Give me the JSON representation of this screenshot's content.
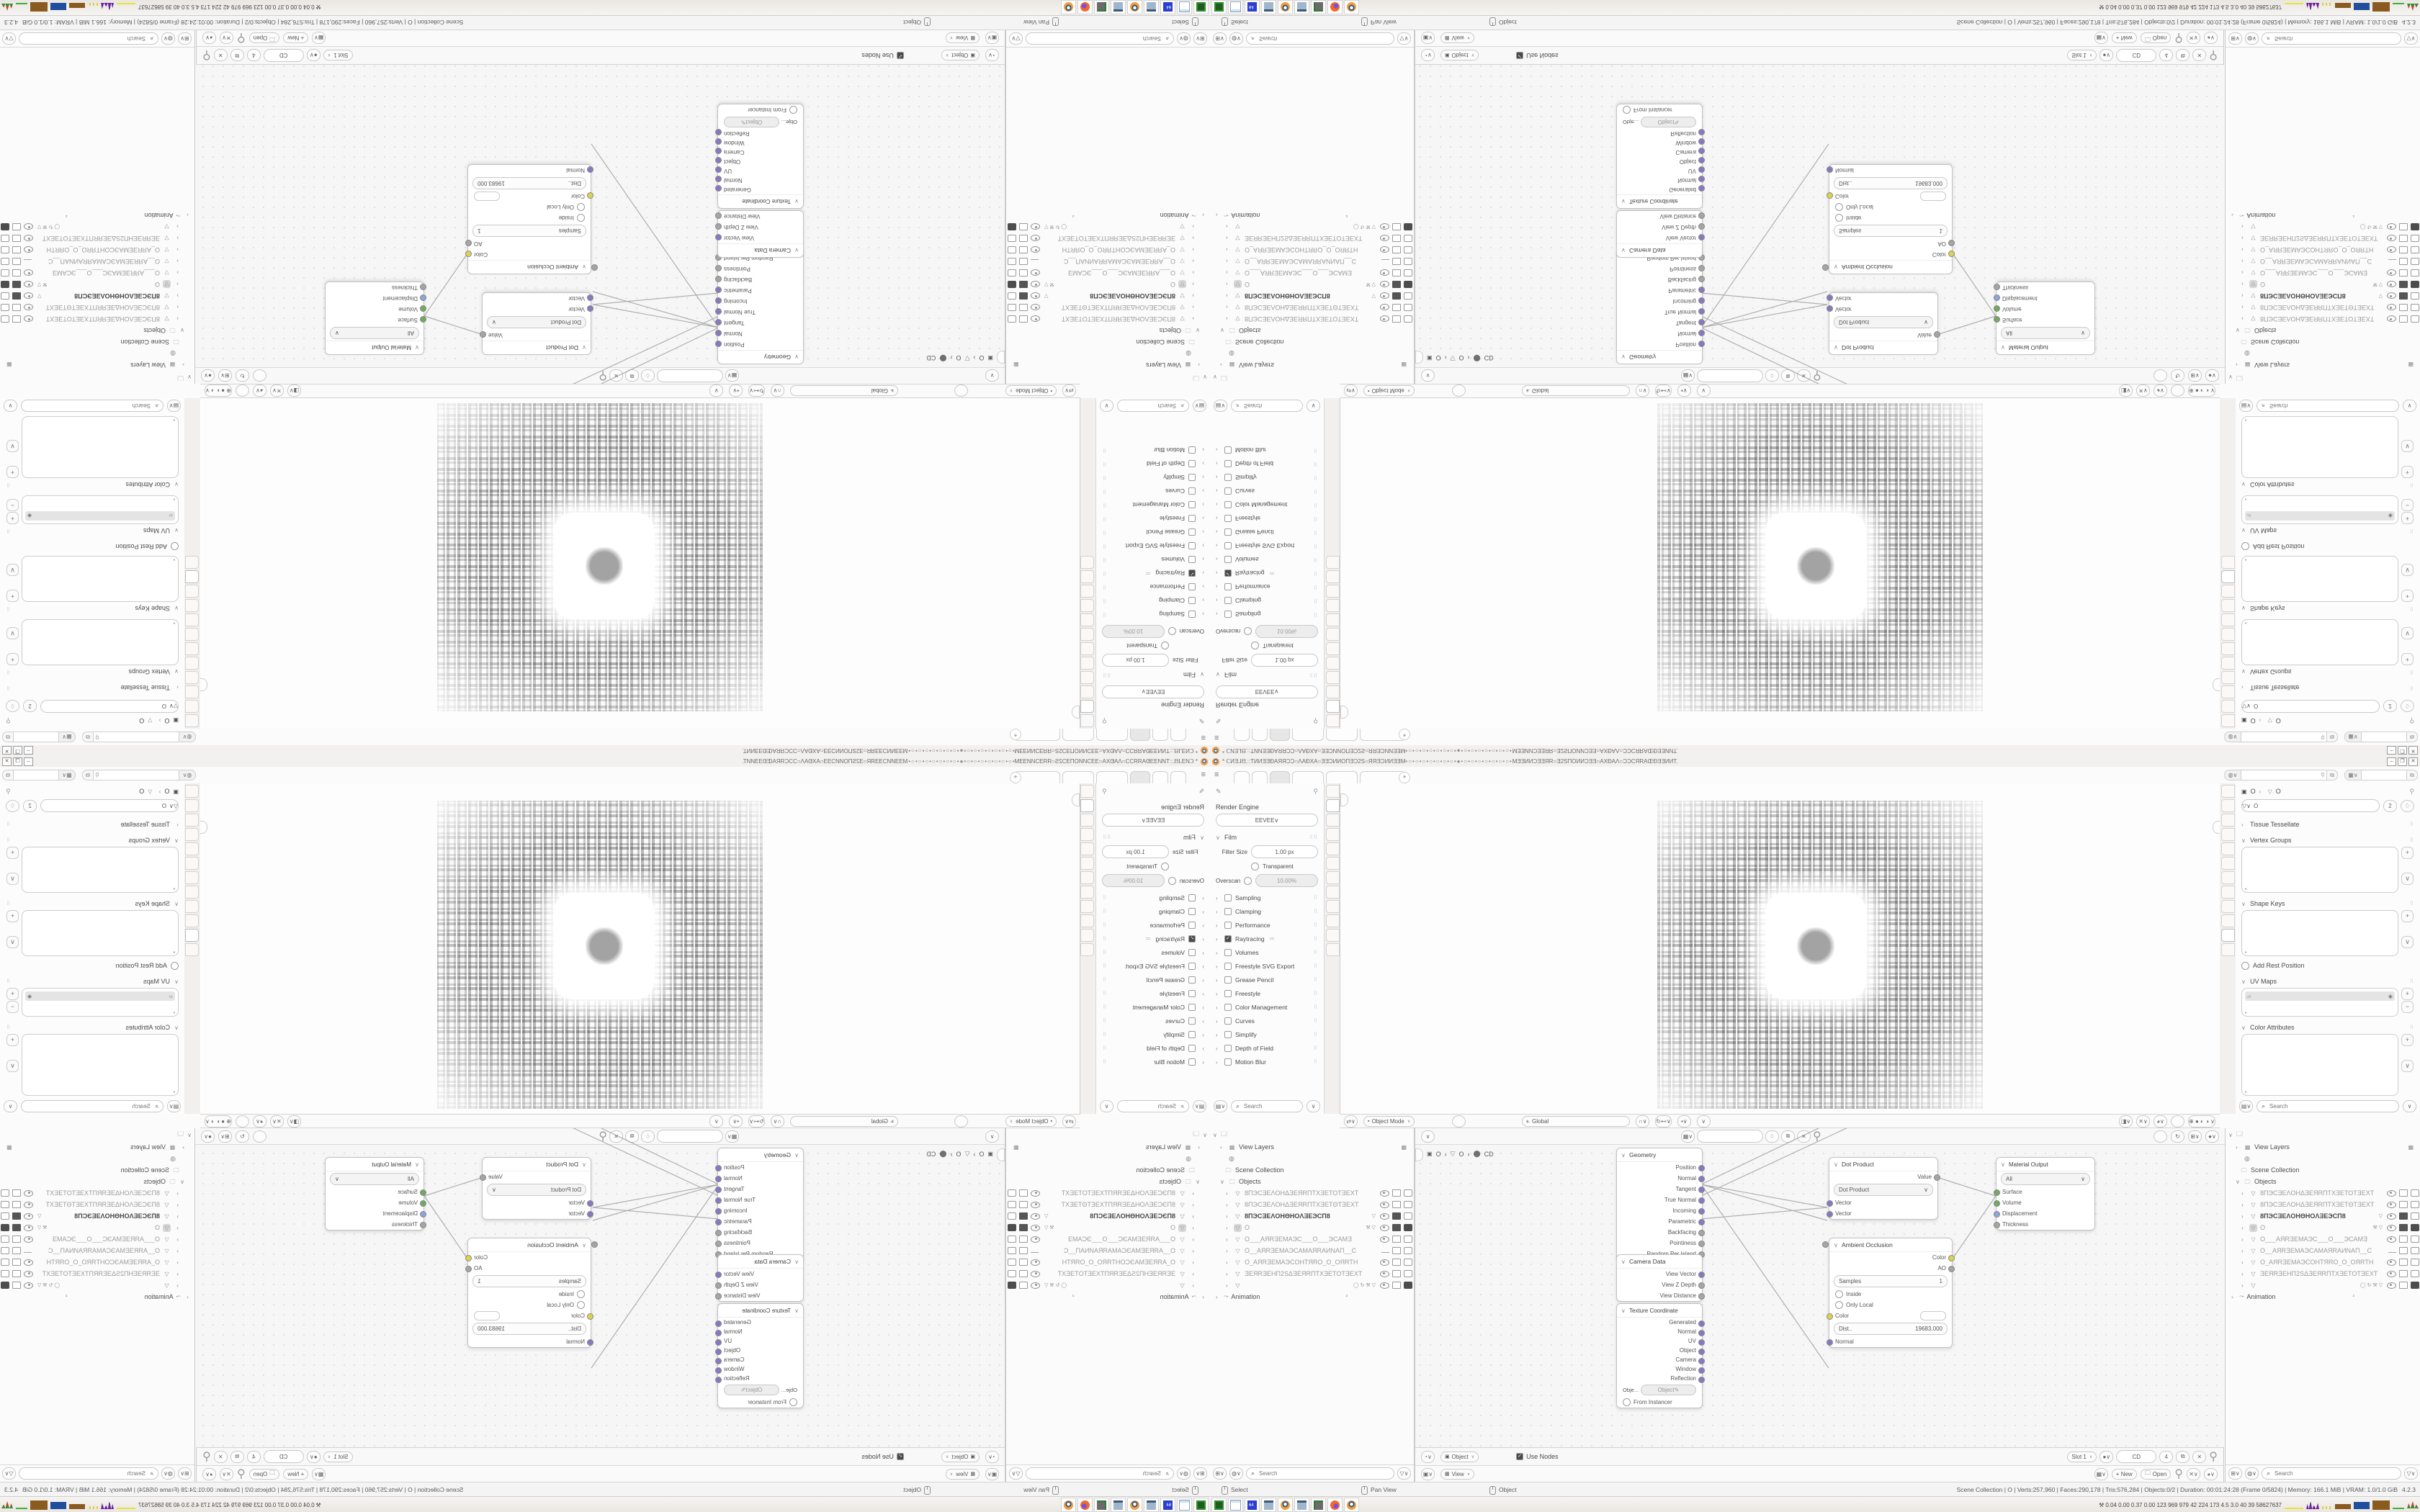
{
  "window": {
    "title_left": "* ᑕИƎ⅃ᗺ.::TИИƎƎĐAЯЯƆƆ○ΛAĐXA○ƎƎƆИИΟΠƎƆ2S○ЯЯƎƆИИƎƎM",
    "title_dots": "•○•○•○•○•○•○•○•●•○•○•○•○•○•○•○•",
    "title_right": "MƎƎИИƆƎƎЯR○Ǝ2SΠΟИИƆƎƎ○AXĐAΛ○ƆƆCЯRAŒĐƎƎИИT.",
    "min": "–",
    "restore": "❐",
    "close": "✕"
  },
  "topbar": {
    "menu_icon": "≡",
    "plus": "+",
    "tabs": [
      {
        "cls": "w1"
      },
      {
        "cls": "w1"
      },
      {
        "cls": "w2 active"
      },
      {
        "cls": "w3"
      },
      {
        "cls": "w3"
      },
      {
        "cls": "w4"
      }
    ]
  },
  "ui": {
    "search": "Search",
    "chev": "∨",
    "expander": "›",
    "pin": "⚲",
    "shield": "♢",
    "dup": "⧉",
    "close": "✕",
    "drag": "⠿⠿"
  },
  "tabs_left": {
    "icons": [
      {
        "g": "Y",
        "cls": ""
      },
      {
        "g": "▣",
        "cls": "active"
      },
      {
        "g": "≡",
        "cls": ""
      },
      {
        "g": "▦",
        "cls": ""
      },
      {
        "g": "✎",
        "cls": ""
      },
      {
        "g": "◐",
        "cls": ""
      },
      {
        "g": "□",
        "cls": ""
      },
      {
        "g": "⚒",
        "cls": ""
      },
      {
        "g": "◌",
        "cls": ""
      },
      {
        "g": "●",
        "cls": ""
      },
      {
        "g": "▽",
        "cls": ""
      },
      {
        "g": "◉",
        "cls": ""
      }
    ]
  },
  "tabs_right": {
    "icons": [
      {
        "g": "Y",
        "cls": ""
      },
      {
        "g": "▣",
        "cls": ""
      },
      {
        "g": "≡",
        "cls": ""
      },
      {
        "g": "▦",
        "cls": ""
      },
      {
        "g": "✎",
        "cls": ""
      },
      {
        "g": "◐",
        "cls": ""
      },
      {
        "g": "□",
        "cls": ""
      },
      {
        "g": "⚒",
        "cls": ""
      },
      {
        "g": "◌",
        "cls": ""
      },
      {
        "g": "●",
        "cls": ""
      },
      {
        "g": "▽",
        "cls": "active"
      },
      {
        "g": "◉",
        "cls": ""
      }
    ]
  },
  "props_render": {
    "engine_label": "Render Engine",
    "engine_value": "EEVEE",
    "film_label": "Film",
    "filter_size_label": "Filter Size",
    "filter_size_value": "1.00 px",
    "transparent_label": "Transparent",
    "overscan_label": "Overscan",
    "overscan_value": "10.00%",
    "sections": [
      {
        "label": "Sampling",
        "chk": "",
        "extra": ""
      },
      {
        "label": "Clamping",
        "chk": "",
        "extra": ""
      },
      {
        "label": "Performance",
        "chk": "",
        "extra": ""
      },
      {
        "label": "Raytracing",
        "chk": "on",
        "extra": "≔"
      },
      {
        "label": "Volumes",
        "chk": "",
        "extra": ""
      },
      {
        "label": "Freestyle SVG Export",
        "chk": "off",
        "extra": ""
      },
      {
        "label": "Grease Pencil",
        "chk": "",
        "extra": ""
      },
      {
        "label": "Freestyle",
        "chk": "off",
        "extra": ""
      },
      {
        "label": "Color Management",
        "chk": "",
        "extra": ""
      },
      {
        "label": "Curves",
        "chk": "",
        "extra": ""
      },
      {
        "label": "Simplify",
        "chk": "off",
        "extra": ""
      },
      {
        "label": "Depth of Field",
        "chk": "",
        "extra": ""
      },
      {
        "label": "Motion Blur",
        "chk": "off",
        "extra": ""
      }
    ]
  },
  "props_data": {
    "crumb_obj": "O",
    "crumb_sep": "›",
    "crumb_data": "O",
    "id_name": "O",
    "id_users": "2",
    "tissue": "Tissue Tessellate",
    "vgroups": "Vertex Groups",
    "skeys": "Shape Keys",
    "addrest": "Add Rest Position",
    "uvmaps": "UV Maps",
    "cattr": "Color Attributes"
  },
  "viewport": {
    "mode": "Object Mode",
    "menus": [
      {
        "label": "View"
      },
      {
        "label": "Select"
      },
      {
        "label": "Add"
      },
      {
        "label": "Object"
      }
    ],
    "orient": "Global"
  },
  "outliner": {
    "view_layers": "View Layers",
    "scene_collection": "Scene Collection",
    "objects": "Objects",
    "animation": "Animation",
    "anim_badge": "²",
    "items": [
      {
        "name": "8ПЭCƎEΛOHΔƎEЯRПTXƎETOTƎEXT",
        "icon": "ic-mesh",
        "cls": "dim",
        "mid": "",
        "eye": "open",
        "scr": "",
        "cam": ""
      },
      {
        "name": "8ПЭCƎEΛOHΔƎEЯRПTXƎETΘTƎEXT",
        "icon": "ic-mesh",
        "cls": "dim",
        "mid": "",
        "eye": "open",
        "scr": "",
        "cam": ""
      },
      {
        "name": "8ПЭCƎEΛOHΘHOΛƎEЭCП8",
        "icon": "ic-mesh",
        "cls": "bold",
        "mid": "▽",
        "eye": "open",
        "scr": "dark",
        "cam": ""
      },
      {
        "name": "O",
        "icon": "ic-mesh",
        "cls": "sel",
        "mid": "⚒ ▽",
        "eye": "open",
        "scr": "dark",
        "cam": "dark"
      },
      {
        "name": "O___AЯRƎEMAЭC___O___ЭCAMƎ",
        "icon": "ic-vcam",
        "cls": "dim",
        "mid": "",
        "eye": "open",
        "scr": "",
        "cam": ""
      },
      {
        "name": "O__AЯRƎEMAЭCAMAЯRAИNAΠ__C",
        "icon": "ic-vcam",
        "cls": "dim",
        "mid": "",
        "eye": "closed",
        "scr": "",
        "cam": ""
      },
      {
        "name": "O_AЯRƎEMAЭCOHTЯRO_O_OЯRTH",
        "icon": "ic-vcam",
        "cls": "dim",
        "mid": "",
        "eye": "open",
        "scr": "",
        "cam": ""
      },
      {
        "name": "ƎEЯRƎEHΠ2SΔƎEЯRПTXƎETOTƎEXT",
        "icon": "ic-mesh",
        "cls": "dim",
        "mid": "",
        "eye": "open",
        "scr": "",
        "cam": ""
      },
      {
        "name": "",
        "icon": "ic-mesh",
        "cls": "",
        "mid": "◯  ↻ ⚒ ▽",
        "eye": "open",
        "scr": "",
        "cam": "dark"
      }
    ]
  },
  "node_editor": {
    "menus": [
      {
        "label": "View"
      },
      {
        "label": "Select"
      },
      {
        "label": "Add"
      },
      {
        "label": "Node"
      }
    ],
    "crumb_obj": "O",
    "crumb_mesh": "O",
    "crumb_mat": "CD",
    "use_nodes": "Use Nodes",
    "slot": "Slot 1",
    "mat_name": "CD",
    "mat_users": "4",
    "nodes": {
      "geometry": {
        "title": "Geometry",
        "outputs": [
          {
            "label": "Position",
            "c": "c-vec"
          },
          {
            "label": "Normal",
            "c": "c-vec"
          },
          {
            "label": "Tangent",
            "c": "c-vec"
          },
          {
            "label": "True Normal",
            "c": "c-vec"
          },
          {
            "label": "Incoming",
            "c": "c-vec"
          },
          {
            "label": "Parametric",
            "c": "c-vec"
          },
          {
            "label": "Backfacing",
            "c": "c-val"
          },
          {
            "label": "Pointiness",
            "c": "c-val"
          },
          {
            "label": "Random Per Island",
            "c": "c-val"
          }
        ]
      },
      "camera": {
        "title": "Camera Data",
        "outputs": [
          {
            "label": "View Vector",
            "c": "c-vec"
          },
          {
            "label": "View Z Depth",
            "c": "c-val"
          },
          {
            "label": "View Distance",
            "c": "c-val"
          }
        ]
      },
      "texcoord": {
        "title": "Texture Coordinate",
        "outputs": [
          {
            "label": "Generated",
            "c": "c-vec"
          },
          {
            "label": "Normal",
            "c": "c-vec"
          },
          {
            "label": "UV",
            "c": "c-vec"
          },
          {
            "label": "Object",
            "c": "c-vec"
          },
          {
            "label": "Camera",
            "c": "c-vec"
          },
          {
            "label": "Window",
            "c": "c-vec"
          },
          {
            "label": "Reflection",
            "c": "c-vec"
          }
        ],
        "obj_label": "Obje...",
        "obj_value": "Object",
        "instancer": "From Instancer"
      },
      "dot_product": {
        "title": "Dot Product",
        "output": "Value",
        "select": "Dot Product",
        "in1": "Vector",
        "in2": "Vector"
      },
      "ao": {
        "title": "Ambient Occlusion",
        "out1": "Color",
        "out2": "AO",
        "samples_label": "Samples",
        "samples_value": "1",
        "inside": "Inside",
        "only_local": "Only Local",
        "color_label": "Color",
        "dist_label": "Dist..",
        "dist_value": "19683.000",
        "normal": "Normal"
      },
      "material_output": {
        "title": "Material Output",
        "select": "All",
        "inputs": [
          {
            "label": "Surface",
            "c": "c-shd"
          },
          {
            "label": "Volume",
            "c": "c-shd"
          },
          {
            "label": "Displacement",
            "c": "c-dis"
          },
          {
            "label": "Thickness",
            "c": "c-val"
          }
        ]
      }
    }
  },
  "image_editor": {
    "mode": "View",
    "menus": [
      {
        "label": "View"
      },
      {
        "label": "Image"
      }
    ],
    "new_label": "+ New",
    "open_label": "Open"
  },
  "statusbar": {
    "hints": [
      {
        "label": "Select"
      },
      {
        "label": "Pan View"
      },
      {
        "label": "Object"
      }
    ],
    "stats": "Scene Collection | O | Verts:257,960 | Faces:290,178 | Tris:576,284 | Objects:0/2 | Duration: 00:01:24:28 (Frame 0/5824) | Memory: 166.1 MiB | VRAM: 1.0/1.0 GiB",
    "version": "4.2.3"
  },
  "taskbar": {
    "apps": [
      {
        "cls": "app-zip"
      },
      {
        "cls": "app-note"
      },
      {
        "cls": "app-floppy"
      },
      {
        "cls": "app-calc"
      },
      {
        "cls": "app-blender"
      },
      {
        "cls": "app-calc"
      },
      {
        "cls": "app-display"
      },
      {
        "cls": "app-firefox"
      },
      {
        "cls": "app-blender"
      }
    ],
    "tray_icon": "⚒",
    "tray_text": "0.04 0.00 0.37 0.00   123   969   979   42   224   173   4.5   3.0   40   39   58627637"
  }
}
